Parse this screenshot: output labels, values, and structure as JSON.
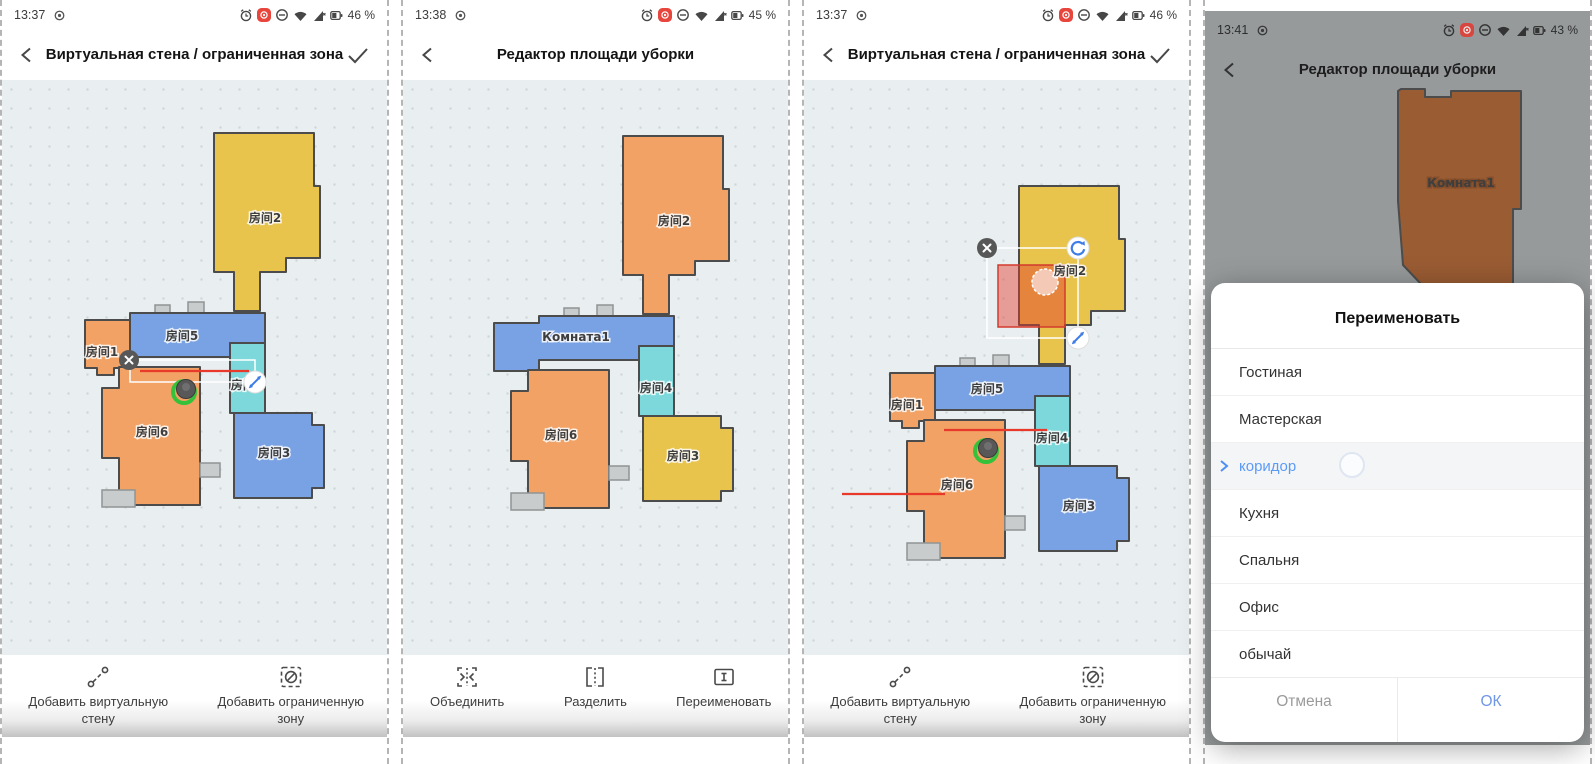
{
  "panels": [
    {
      "time": "13:37",
      "battery": "46 %",
      "title": "Виртуальная стена / ограниченная зона",
      "rooms": {
        "r1": "房间1",
        "r2": "房间2",
        "r3": "房间3",
        "r4": "房间4",
        "r5": "房间5",
        "r6": "房间6"
      },
      "actions": {
        "wall": "Добавить виртуальную стену",
        "zone": "Добавить ограниченную зону"
      }
    },
    {
      "time": "13:38",
      "battery": "45 %",
      "title": "Редактор площади уборки",
      "rooms": {
        "r2": "房间2",
        "merged": "Комната1",
        "r3": "房间3",
        "r4": "房间4",
        "r6": "房间6"
      },
      "toast": "Выберите комнату для разделения",
      "actions": {
        "merge": "Объединить",
        "split": "Разделить",
        "rename": "Переименовать"
      }
    },
    {
      "time": "13:37",
      "battery": "46 %",
      "title": "Виртуальная стена / ограниченная зона",
      "rooms": {
        "r1": "房间1",
        "r2": "房间2",
        "r3": "房间3",
        "r4": "房间4",
        "r5": "房间5",
        "r6": "房间6"
      },
      "actions": {
        "wall": "Добавить виртуальную стену",
        "zone": "Добавить ограниченную зону"
      }
    },
    {
      "time": "13:41",
      "battery": "43 %",
      "title": "Редактор площади уборки",
      "rooms": {
        "merged": "Комната1"
      },
      "dialog": {
        "title": "Переименовать",
        "options": [
          "Гостиная",
          "Мастерская",
          "коридор",
          "Кухня",
          "Спальня",
          "Офис",
          "обычай"
        ],
        "selected": "коридор",
        "cancel": "Отмена",
        "ok": "ОК"
      }
    }
  ],
  "icon_colors": {
    "status": "#3c3c3c",
    "record_badge": "#e8453c",
    "accent_blue": "#3e7ce8",
    "wall_red": "#e8392b"
  }
}
